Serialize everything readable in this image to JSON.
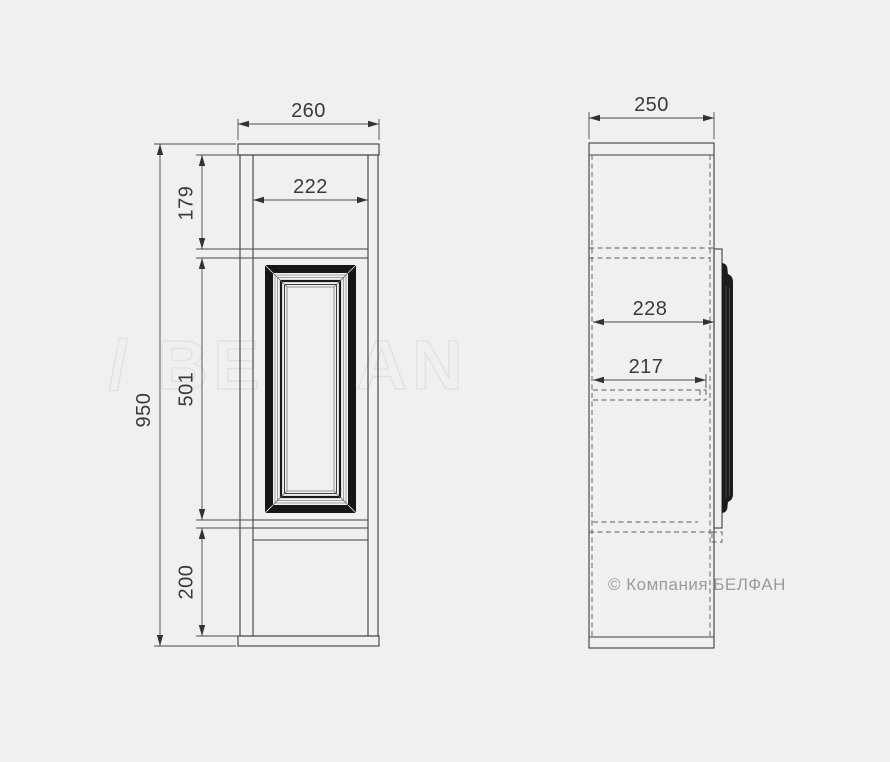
{
  "title": "furniture technical drawing",
  "background": "#f0f0f0",
  "watermark": {
    "text": "/ BELFAN",
    "stroke_color": "#e2e2e2"
  },
  "copyright": {
    "text": "© Компания БЕЛФАН",
    "color": "#9b9b9b"
  },
  "front_view": {
    "label": "front view",
    "dims": {
      "overall_width": "260",
      "interior_width": "222",
      "overall_height": "950",
      "top_section_height": "179",
      "door_height": "501",
      "base_height": "200"
    }
  },
  "side_view": {
    "label": "side view",
    "dims": {
      "overall_depth": "250",
      "interior_depth": "228",
      "shelf_depth": "217"
    }
  },
  "colors": {
    "line": "#3e3e3e",
    "molding_dark": "#161616",
    "dim_text": "#3a3a3a"
  }
}
